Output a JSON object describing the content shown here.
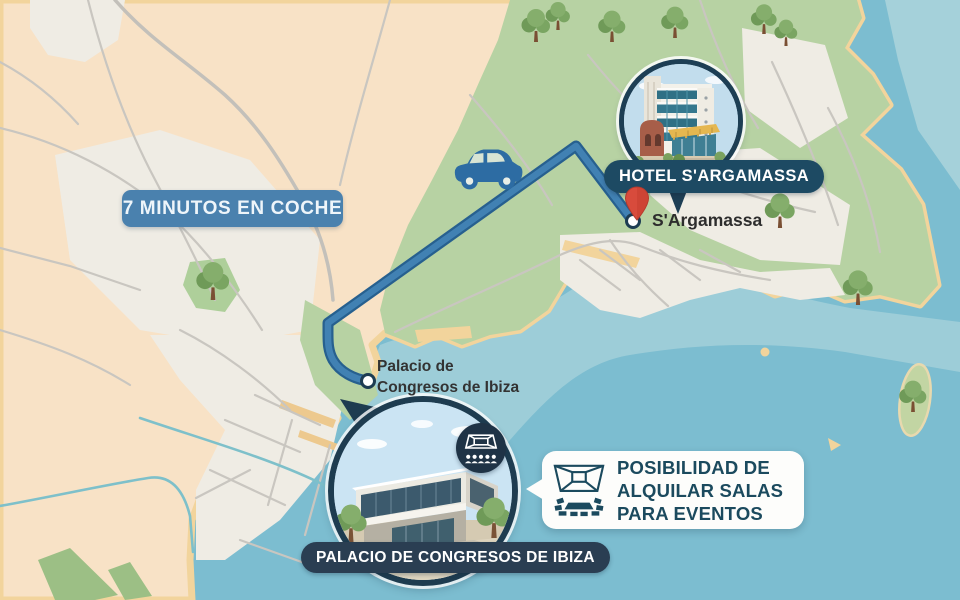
{
  "map": {
    "travel_time": "7 MINUTOS EN COCHE",
    "hotel": {
      "badge": "HOTEL S'ARGAMASSA",
      "pin_label": "S'Argamassa"
    },
    "venue": {
      "label_line1": "Palacio de",
      "label_line2": "Congresos de Ibiza",
      "badge": "PALACIO DE CONGRESOS DE IBIZA"
    },
    "callout": {
      "line1": "POSIBILIDAD DE",
      "line2": "ALQUILAR SALAS",
      "line3": "PARA EVENTOS"
    },
    "colors": {
      "water": "#7cbdd0",
      "shallow_water": "#a5d1da",
      "land": "#f8e2c6",
      "urban": "#efece4",
      "forest": "#b7d2a3",
      "sand": "#f2d49c",
      "road": "#c9c6c0",
      "route": "#4181b3",
      "route_border": "#27608f",
      "travel_badge_bg": "#4a81ae",
      "hotel_badge_bg": "#1d4a63",
      "venue_badge_bg": "#2a3e52",
      "callout_text": "#1b4a5e",
      "pin_red": "#d84b3c"
    }
  }
}
